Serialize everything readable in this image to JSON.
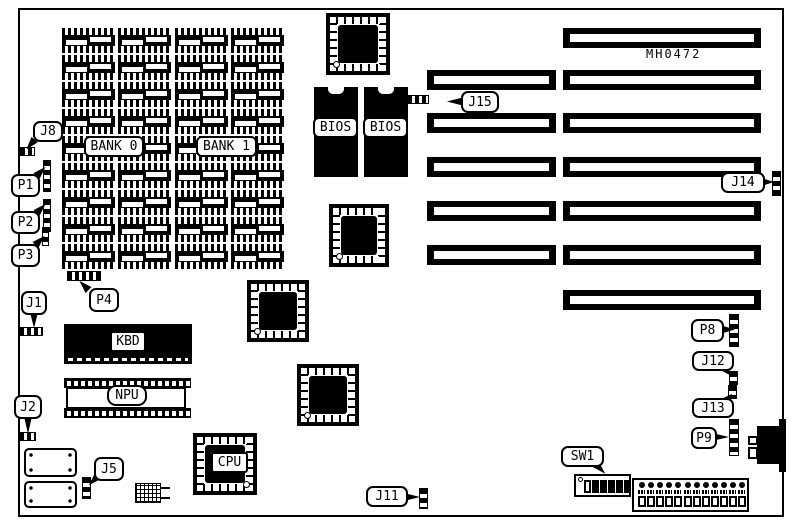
{
  "board": {
    "part_number": "MH0472",
    "memory": {
      "bank0": "BANK 0",
      "bank1": "BANK 1",
      "rows": 9,
      "cols": 4
    },
    "chips": {
      "kbd": "KBD",
      "npu": "NPU",
      "cpu": "CPU",
      "bios": "BIOS"
    },
    "callouts": {
      "j8": "J8",
      "p1": "P1",
      "p2": "P2",
      "p3": "P3",
      "j1": "J1",
      "p4": "P4",
      "j2": "J2",
      "j5": "J5",
      "j11": "J11",
      "j15": "J15",
      "j14": "J14",
      "p8": "P8",
      "j12": "J12",
      "j13": "J13",
      "p9": "P9",
      "sw1": "SW1"
    },
    "slots": {
      "long_count": 7,
      "short_count": 5
    },
    "power_pins": 12,
    "dip_positions": 6
  }
}
